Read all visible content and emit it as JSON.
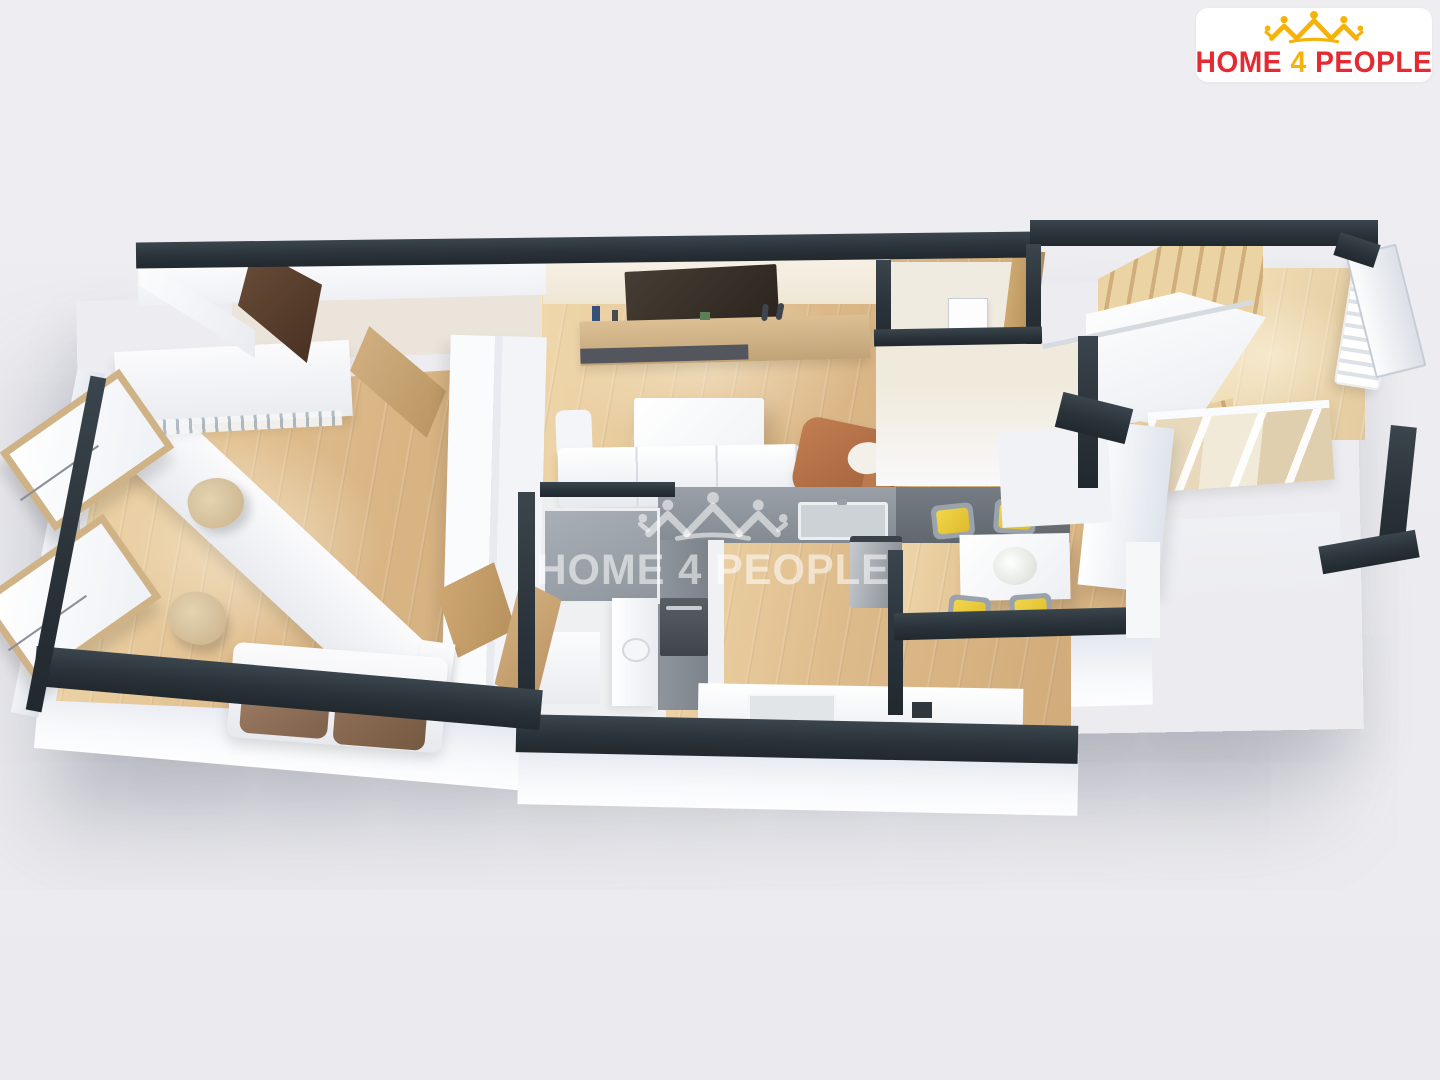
{
  "page": {
    "background_color": "#ededf0"
  },
  "logo_card": {
    "brand_word_1": "HOME",
    "brand_word_2": "4",
    "brand_word_3": "PEOPLE",
    "icon": "houses-and-people-crown-icon",
    "colors": {
      "text_red": "#e52b31",
      "icon_yellow": "#f5b30a",
      "card_bg": "#ffffff"
    }
  },
  "watermark": {
    "word_1": "HOME",
    "word_2": "4",
    "word_3": "PEOPLE",
    "icon": "houses-and-people-crown-icon",
    "color": "#ffffff",
    "opacity": 0.55
  },
  "floorplan": {
    "description": "3D top-down render of an apartment floor plan",
    "colors": {
      "wall_top": "#2d363c",
      "wall_face": "#f4f5f8",
      "wood_floor": "#debb8b",
      "pale_floor": "#f0ebe1",
      "kitchen_counter_gray": "#8b9298",
      "counter_dark_gray": "#686e74",
      "shower_gray": "#9ba1a8",
      "wood_furniture": "#c9a672",
      "entry_door_brown": "#5c4232",
      "dining_cushion_yellow": "#e9c93c",
      "lounger_brown": "#b5764e",
      "pillow_brown": "#8f6c55",
      "office_chair_tan": "#d8c29c"
    },
    "rooms": [
      {
        "name": "office-bedroom",
        "furniture": [
          "desk",
          "office-chair",
          "office-chair",
          "shelf-unit",
          "wardrobe",
          "sofa",
          "casement-windows"
        ]
      },
      {
        "name": "living-room",
        "furniture": [
          "wall-tv",
          "media-bench",
          "coffee-table",
          "sofa",
          "lounge-chair"
        ]
      },
      {
        "name": "bathroom",
        "furniture": [
          "shower",
          "sink-cabinet",
          "door"
        ]
      },
      {
        "name": "kitchen",
        "furniture": [
          "counter",
          "sink",
          "fridge",
          "oven",
          "cooktop"
        ]
      },
      {
        "name": "dining-nook",
        "furniture": [
          "dining-table",
          "chair",
          "chair",
          "chair",
          "chair",
          "flower-vase"
        ]
      },
      {
        "name": "entry-hall",
        "furniture": [
          "front-door",
          "staircase",
          "radiator",
          "glass-partition",
          "wardrobe-door"
        ]
      }
    ]
  }
}
